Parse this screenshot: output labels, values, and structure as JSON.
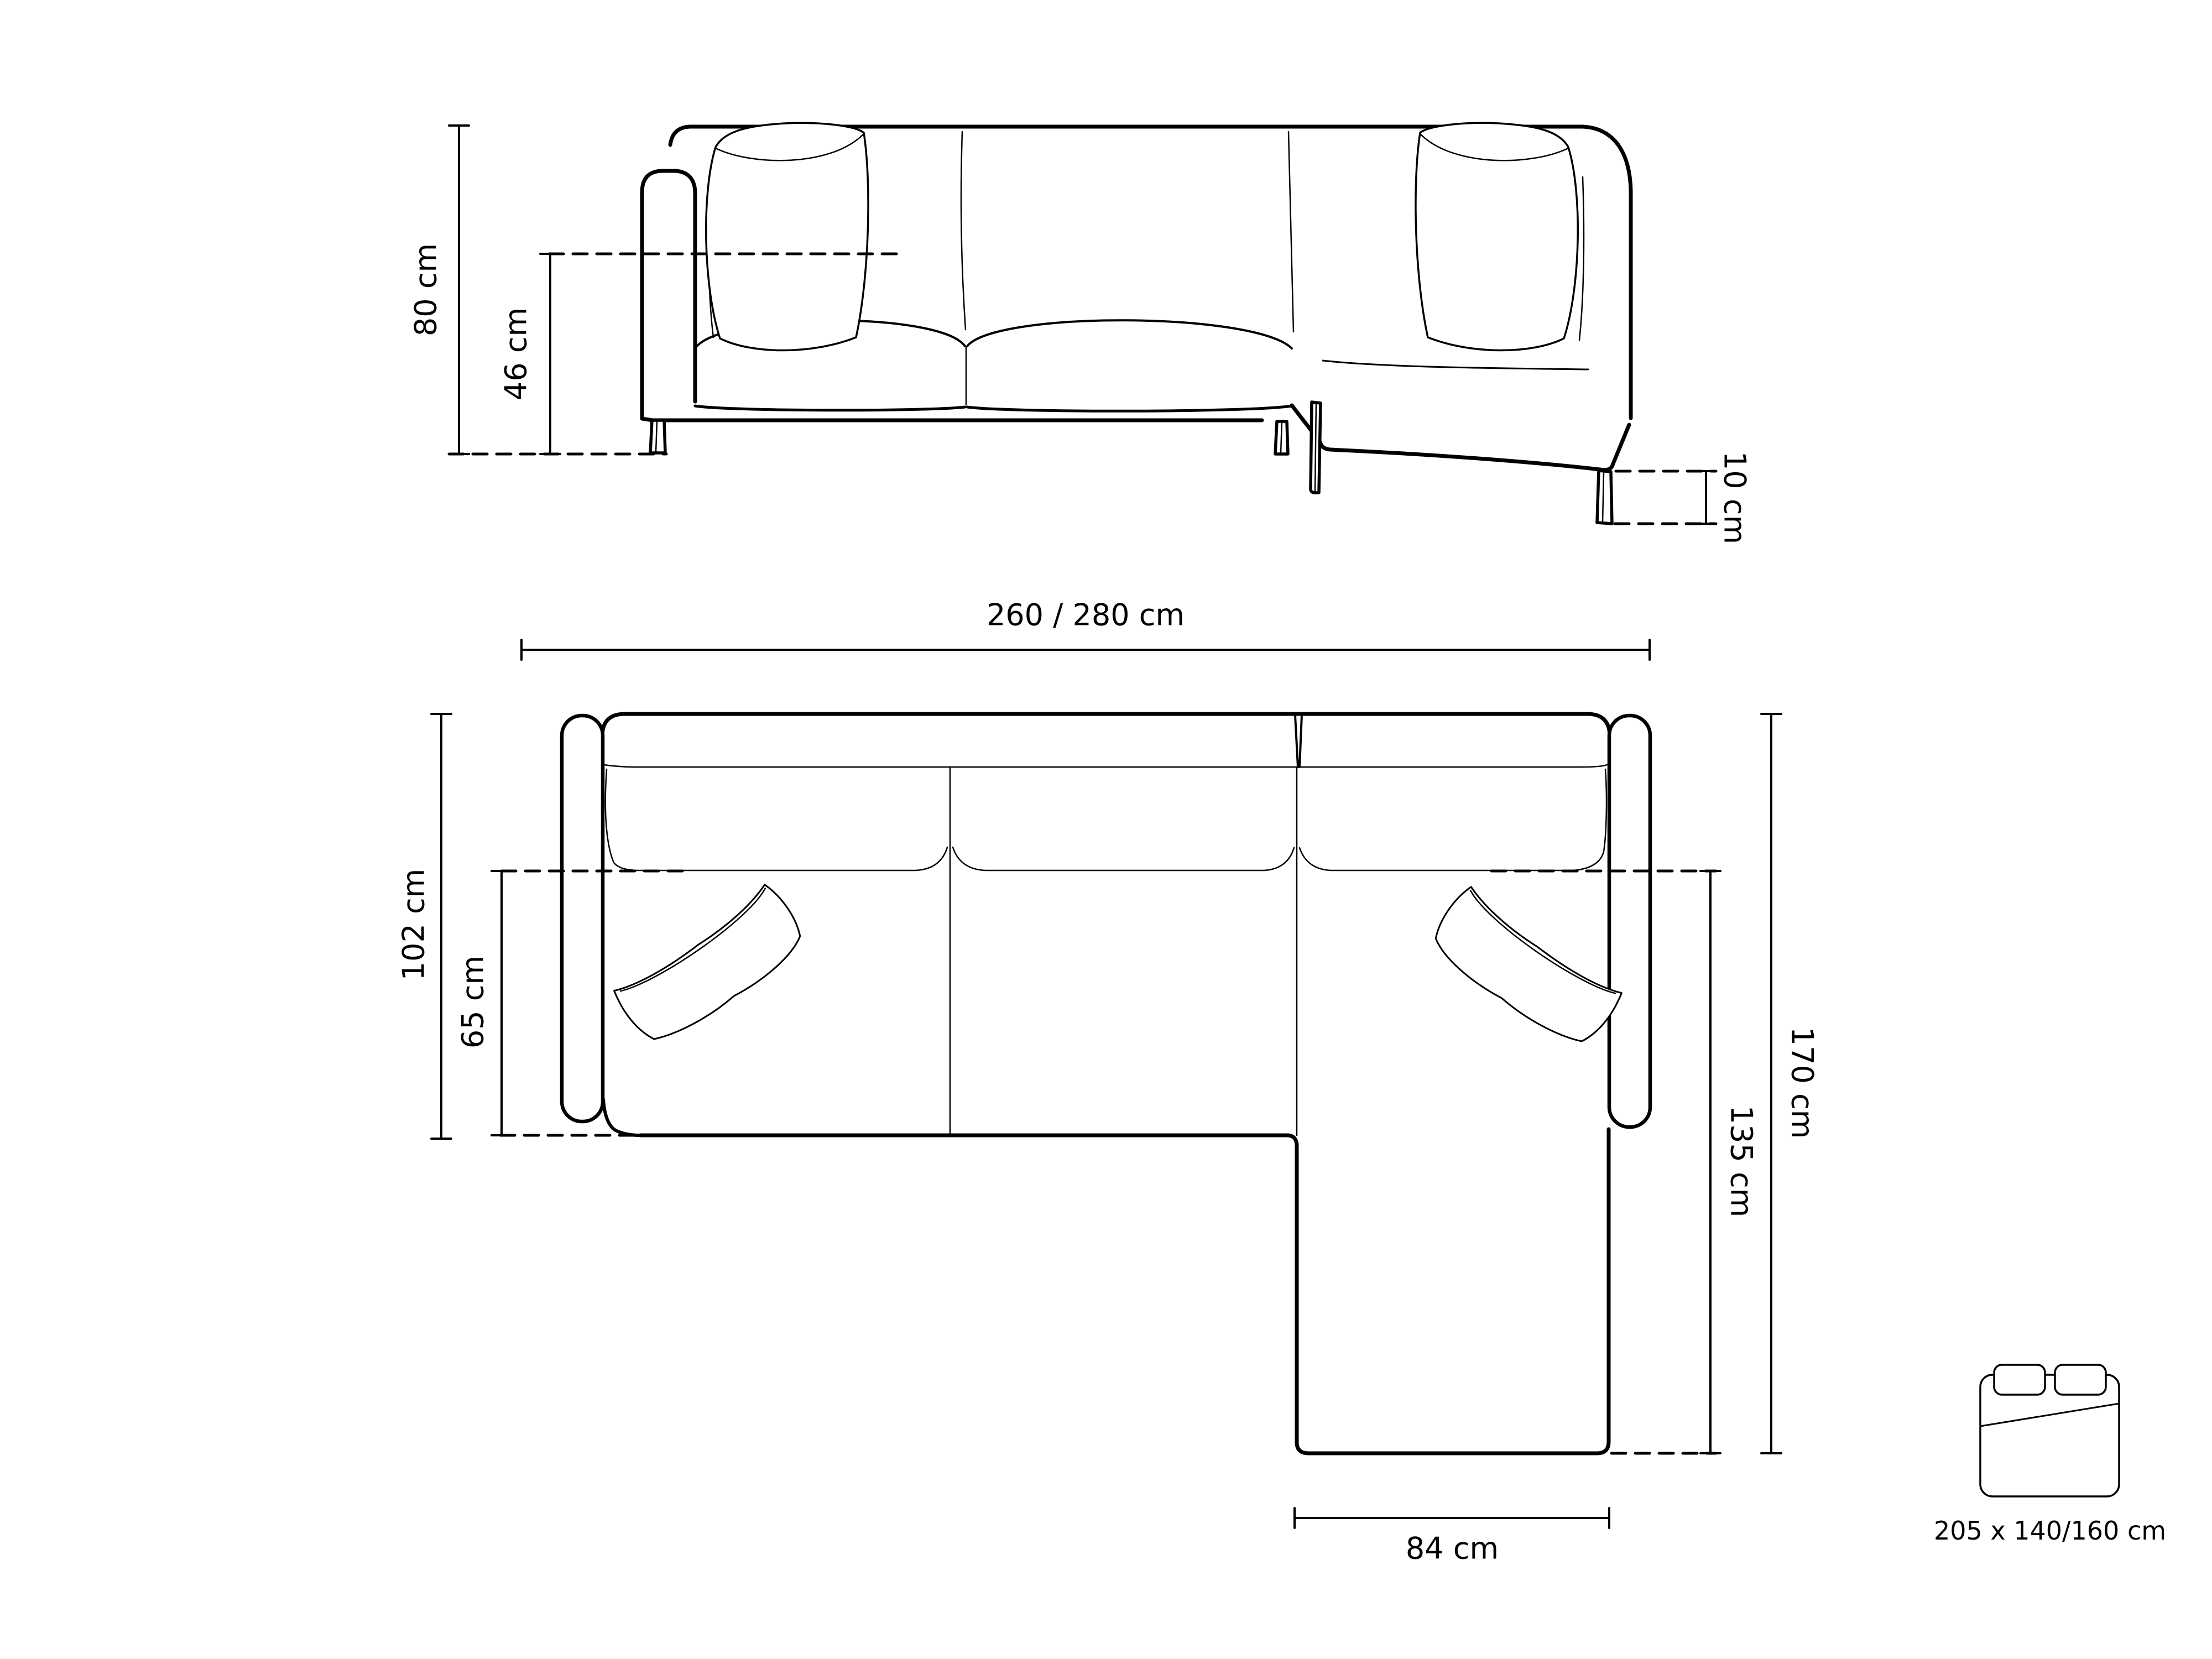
{
  "colors": {
    "line": "#000000",
    "text": "#000000",
    "background": "#ffffff"
  },
  "front_view": {
    "height_total": "80 cm",
    "seat_height": "46 cm",
    "leg_height": "10 cm"
  },
  "plan_view": {
    "width_total": "260 / 280 cm",
    "depth_total": "102 cm",
    "seat_depth": "65 cm",
    "depth_with_chaise": "170 cm",
    "chaise_depth": "135 cm",
    "chaise_width": "84 cm"
  },
  "sleeping_area": {
    "icon": "bed-icon",
    "size": "205 x 140/160 cm"
  }
}
